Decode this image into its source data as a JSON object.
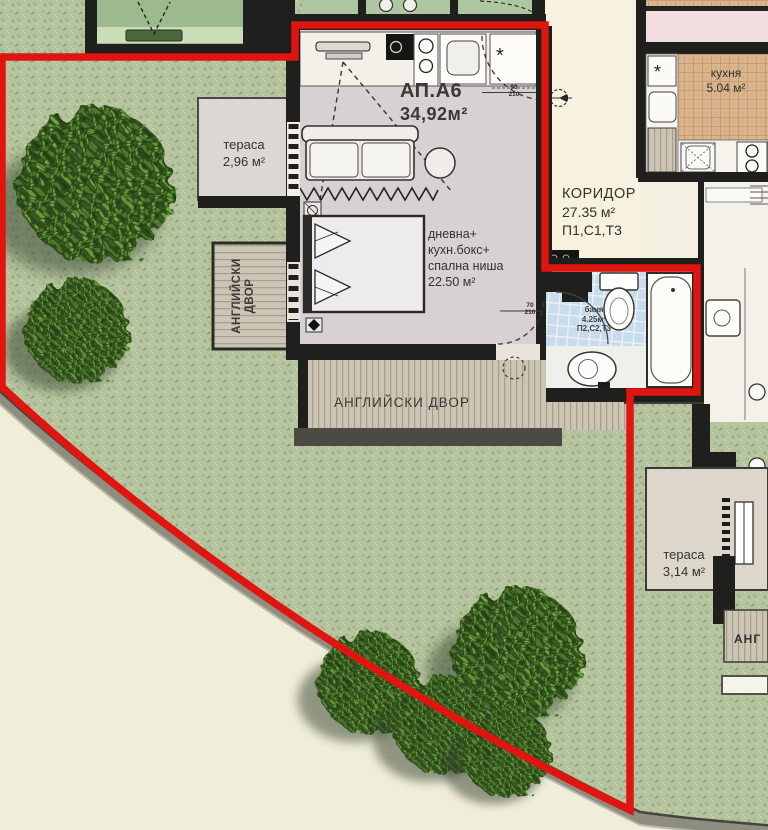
{
  "palette": {
    "boundary_red": "#e0150f",
    "lawn_green": "#b5c49e",
    "wall_black": "#1f1f1d",
    "deck_tan": "#cbc5b5",
    "bath_blue": "#c9dcec",
    "kitchen_tan": "#d9b48c",
    "corridor_cream": "#f6f2df",
    "pink_room": "#f2dde1",
    "sidewalk": "#f0eddb"
  },
  "apartment": {
    "id": "АП.А6",
    "area": "34,92м²"
  },
  "rooms": {
    "terrace_left": {
      "name": "тераса",
      "area": "2,96 м²"
    },
    "living": {
      "lines": [
        "дневна+",
        "кухн.бокс+",
        "спална ниша"
      ],
      "area": "22.50 м²"
    },
    "corridor": {
      "name": "КОРИДОР",
      "area": "27.35 м²",
      "units": "П1,С1,Т3"
    },
    "kitchen": {
      "name": "кухня",
      "area": "5.04 м²"
    },
    "bathroom": {
      "name": "баня",
      "area": "4.25м²",
      "units": "П2,С2,Т3"
    },
    "terrace_right": {
      "name": "тераса",
      "area": "3,14 м²"
    },
    "english_yard_bottom": {
      "name": "АНГЛИЙСКИ ДВОР"
    },
    "english_yard_left": {
      "line1": "АНГЛИЙСКИ",
      "line2": "ДВОР"
    },
    "english_yard_partial": {
      "name": "АНГ"
    }
  },
  "dimensions": {
    "entry_door": {
      "width": "90",
      "height": "210"
    },
    "bath_door": {
      "width": "70",
      "height": "210"
    }
  }
}
